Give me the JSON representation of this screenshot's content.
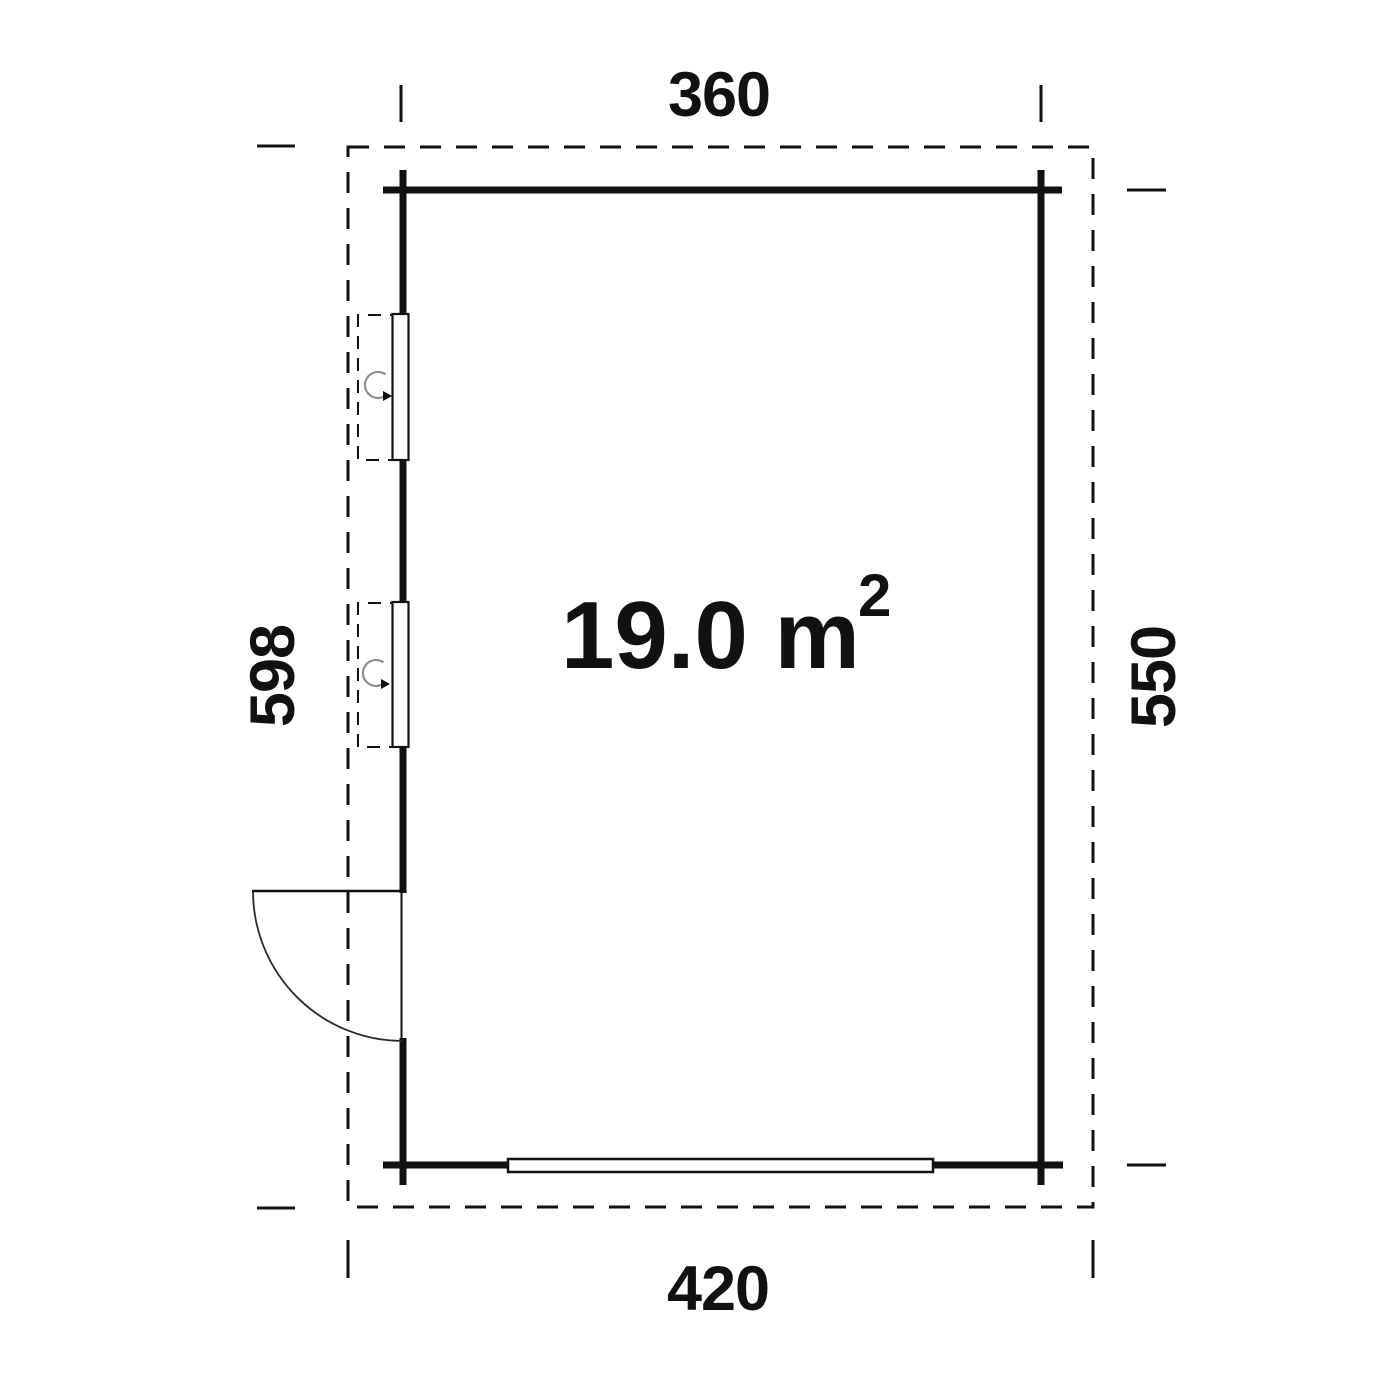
{
  "plan": {
    "area": {
      "text": "19.0 m",
      "superscript": "2"
    },
    "dims": {
      "top": "360",
      "bottom": "420",
      "left": "598",
      "right": "550"
    }
  },
  "colors": {
    "line": "#111111",
    "swing_arc": "#8f8f8f",
    "background": "#ffffff"
  }
}
